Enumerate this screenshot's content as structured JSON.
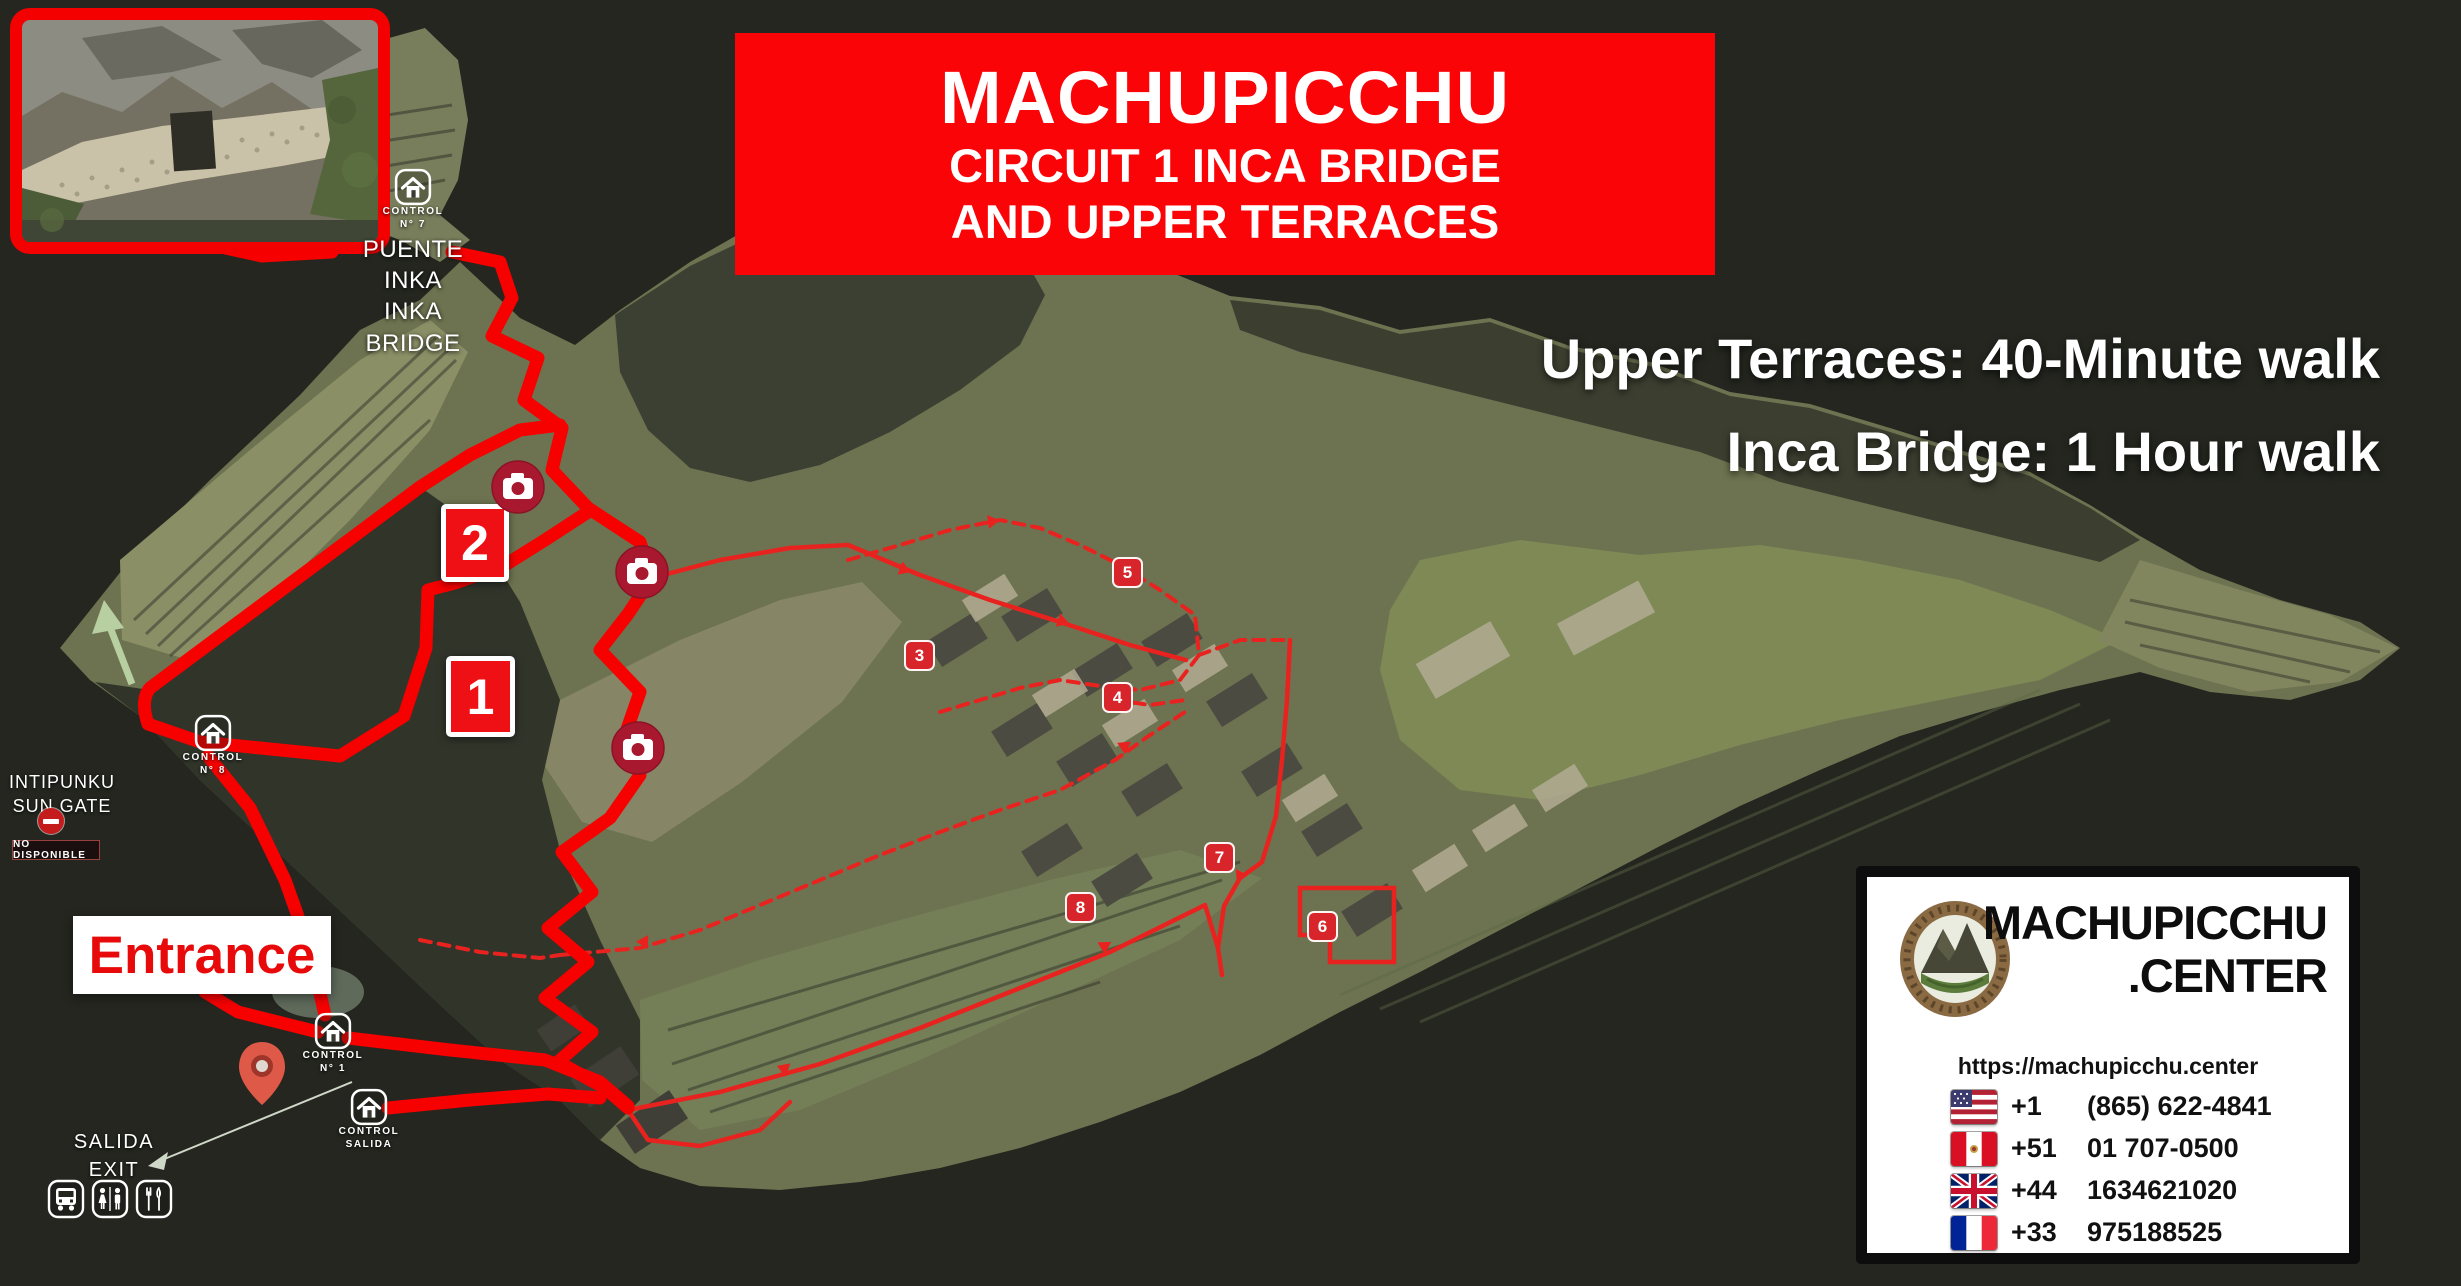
{
  "banner": {
    "title": "MACHUPICCHU",
    "subtitle1": "CIRCUIT 1 INCA BRIDGE",
    "subtitle2": "AND UPPER TERRACES"
  },
  "walk_info": {
    "line1": "Upper Terraces: 40-Minute walk",
    "line2": "Inca Bridge: 1 Hour walk"
  },
  "bridge_label": {
    "line1": "PUENTE INKA",
    "line2": "INKA BRIDGE"
  },
  "controls": {
    "c7": {
      "line1": "CONTROL",
      "line2": "N° 7"
    },
    "c8": {
      "line1": "CONTROL",
      "line2": "N° 8"
    },
    "c1": {
      "line1": "CONTROL",
      "line2": "N° 1"
    },
    "salida": {
      "line1": "CONTROL",
      "line2": "SALIDA"
    }
  },
  "sun_gate": {
    "line1": "INTIPUNKU",
    "line2": "SUN GATE",
    "status": "NO DISPONIBLE"
  },
  "entrance": {
    "label": "Entrance"
  },
  "exit_label": {
    "line1": "SALIDA",
    "line2": "EXIT"
  },
  "stops": {
    "s1": "1",
    "s2": "2",
    "s3": "3",
    "s4": "4",
    "s5": "5",
    "s6": "6",
    "s7": "7",
    "s8": "8"
  },
  "contact": {
    "brand_line1": "MACHUPICCHU",
    "brand_line2": ".CENTER",
    "url": "https://machupicchu.center",
    "phones": [
      {
        "flag": "us",
        "code": "+1",
        "number": "(865) 622-4841"
      },
      {
        "flag": "pe",
        "code": "+51",
        "number": "01 707-0500"
      },
      {
        "flag": "gb",
        "code": "+44",
        "number": "1634621020"
      },
      {
        "flag": "fr",
        "code": "+33",
        "number": "975188525"
      }
    ]
  },
  "colors": {
    "banner_red": "#fa0408",
    "route_red": "#f60000",
    "thin_route_red": "#e8231f",
    "badge_red": "#d7252b",
    "camera_red": "#a8182f",
    "pin_red": "#de5948"
  }
}
